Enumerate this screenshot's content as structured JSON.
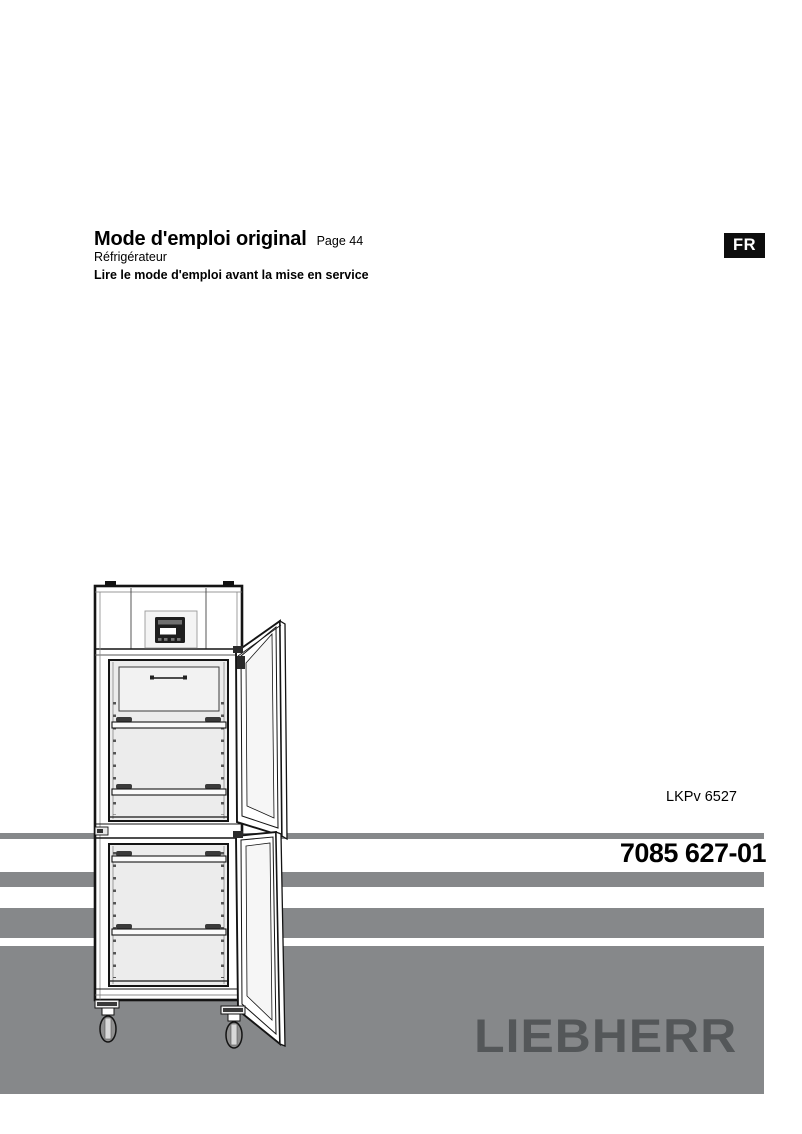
{
  "page": {
    "title": "Mode d'emploi original",
    "page_ref": "Page 44",
    "subtitle": "Réfrigérateur",
    "notice": "Lire le mode d'emploi avant la mise en service",
    "language_badge": "FR",
    "model": "LKPv 6527",
    "document_number": "7085 627-01",
    "brand_logo": "LIEBHERR"
  },
  "colors": {
    "stripe_gray": "#86888a",
    "logo_gray": "#545759",
    "badge_bg": "#0d0d0d",
    "badge_text": "#ffffff"
  },
  "illustration": {
    "name": "refrigerator-two-compartments-doors-open"
  }
}
